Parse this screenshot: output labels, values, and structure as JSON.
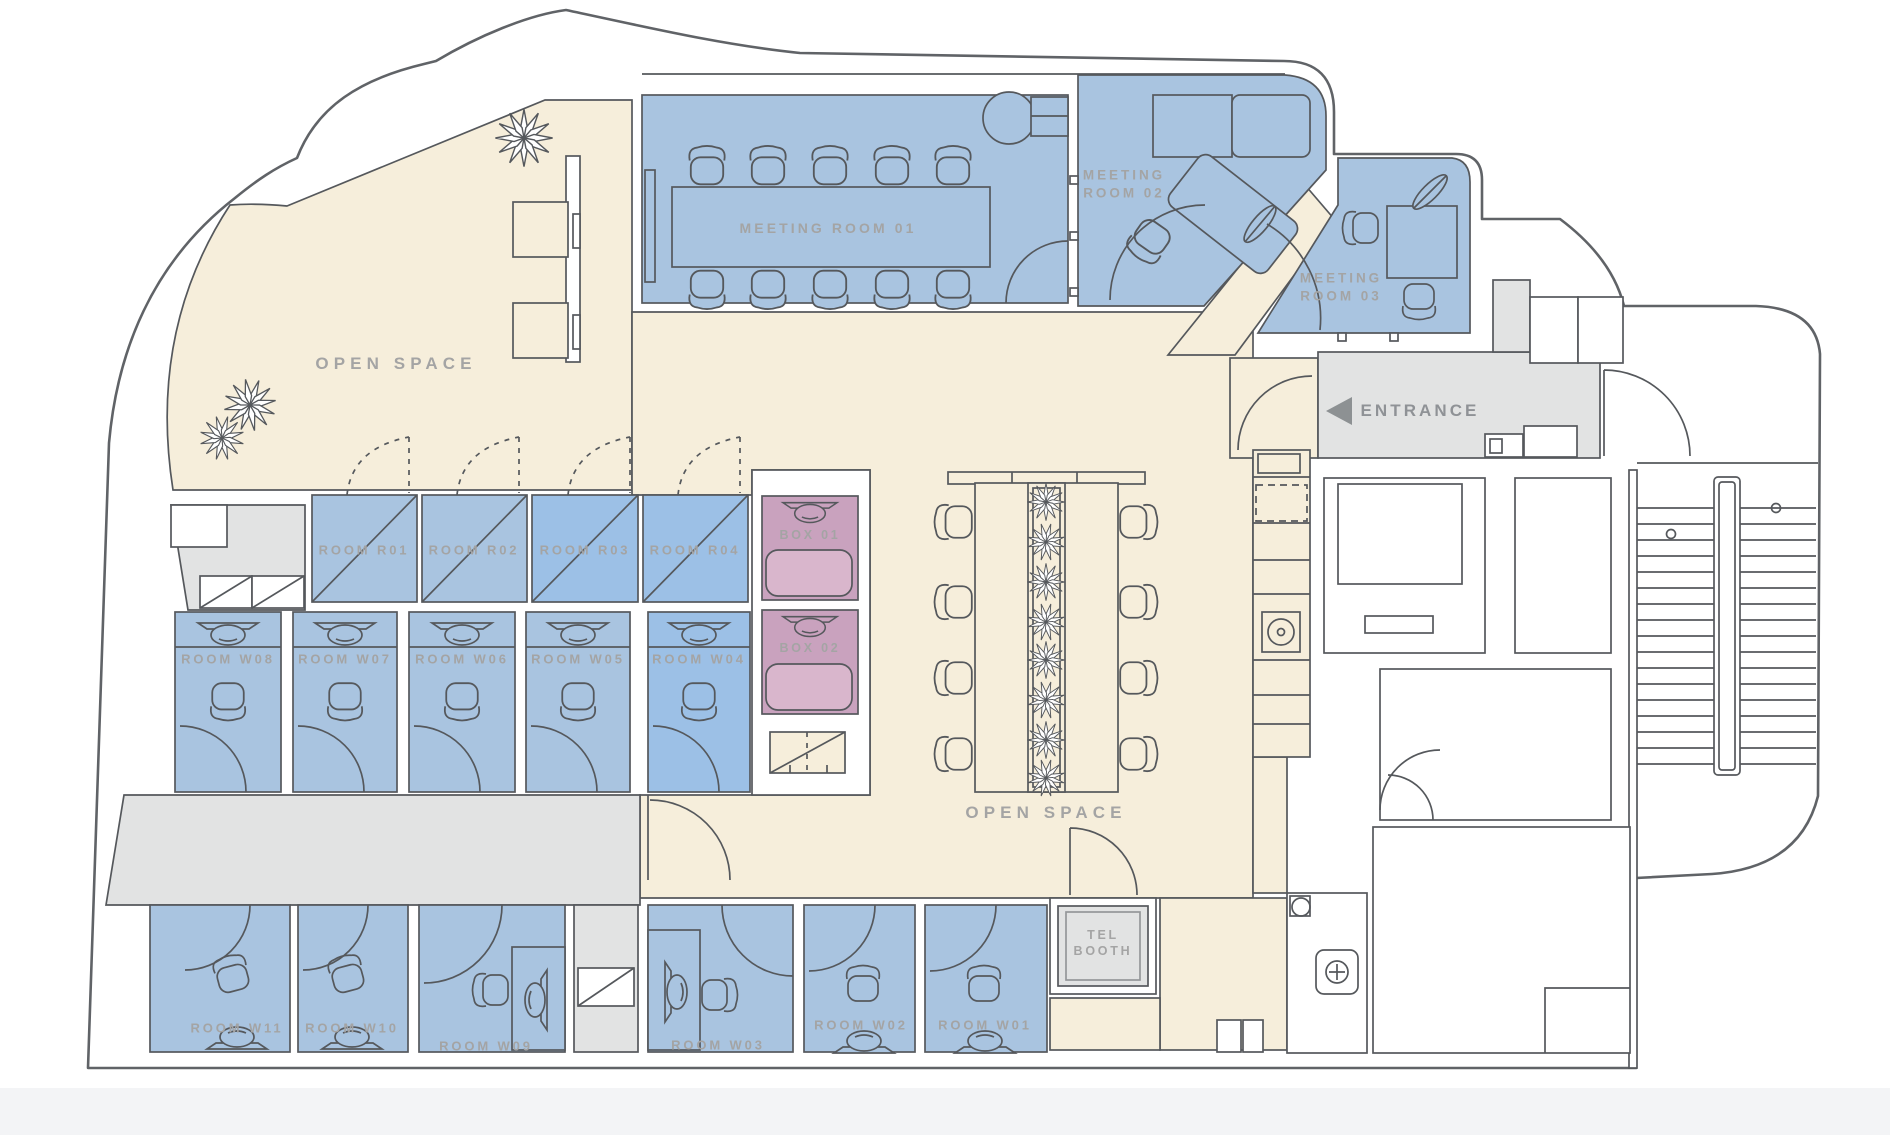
{
  "colors": {
    "floor_beige": "#f6eedb",
    "corridor_gray": "#e2e3e3",
    "room_blue": "#a9c4e0",
    "room_blue_alt": "#9cc0e6",
    "box_pink": "#c9a2be",
    "box_pink_light": "#d9b6cc",
    "wall_line": "#55585c",
    "outline_color": "#606367",
    "label_gray": "#a4a4a4",
    "entrance_arrow": "#8d9193"
  },
  "open_spaces": [
    {
      "id": "left",
      "label": "OPEN SPACE"
    },
    {
      "id": "center",
      "label": "OPEN SPACE"
    }
  ],
  "entrance": {
    "label": "ENTRANCE"
  },
  "meeting_rooms": [
    {
      "id": "01",
      "label": "MEETING ROOM 01"
    },
    {
      "id": "02",
      "label": "MEETING\nROOM 02"
    },
    {
      "id": "03",
      "label": "MEETING\nROOM 03"
    }
  ],
  "r_rooms": [
    {
      "label": "ROOM R01"
    },
    {
      "label": "ROOM R02"
    },
    {
      "label": "ROOM R03"
    },
    {
      "label": "ROOM R04"
    }
  ],
  "w_rooms_middle": [
    {
      "label": "ROOM W08"
    },
    {
      "label": "ROOM W07"
    },
    {
      "label": "ROOM W06"
    },
    {
      "label": "ROOM W05"
    },
    {
      "label": "ROOM W04"
    }
  ],
  "boxes": [
    {
      "label": "BOX 01"
    },
    {
      "label": "BOX 02"
    }
  ],
  "w_rooms_bottom": [
    {
      "label": "ROOM W11"
    },
    {
      "label": "ROOM W10"
    },
    {
      "label": "ROOM W09"
    },
    {
      "label": "ROOM W03"
    },
    {
      "label": "ROOM W02"
    },
    {
      "label": "ROOM W01"
    }
  ],
  "tel_booth": {
    "label": "TEL\nBOOTH"
  }
}
